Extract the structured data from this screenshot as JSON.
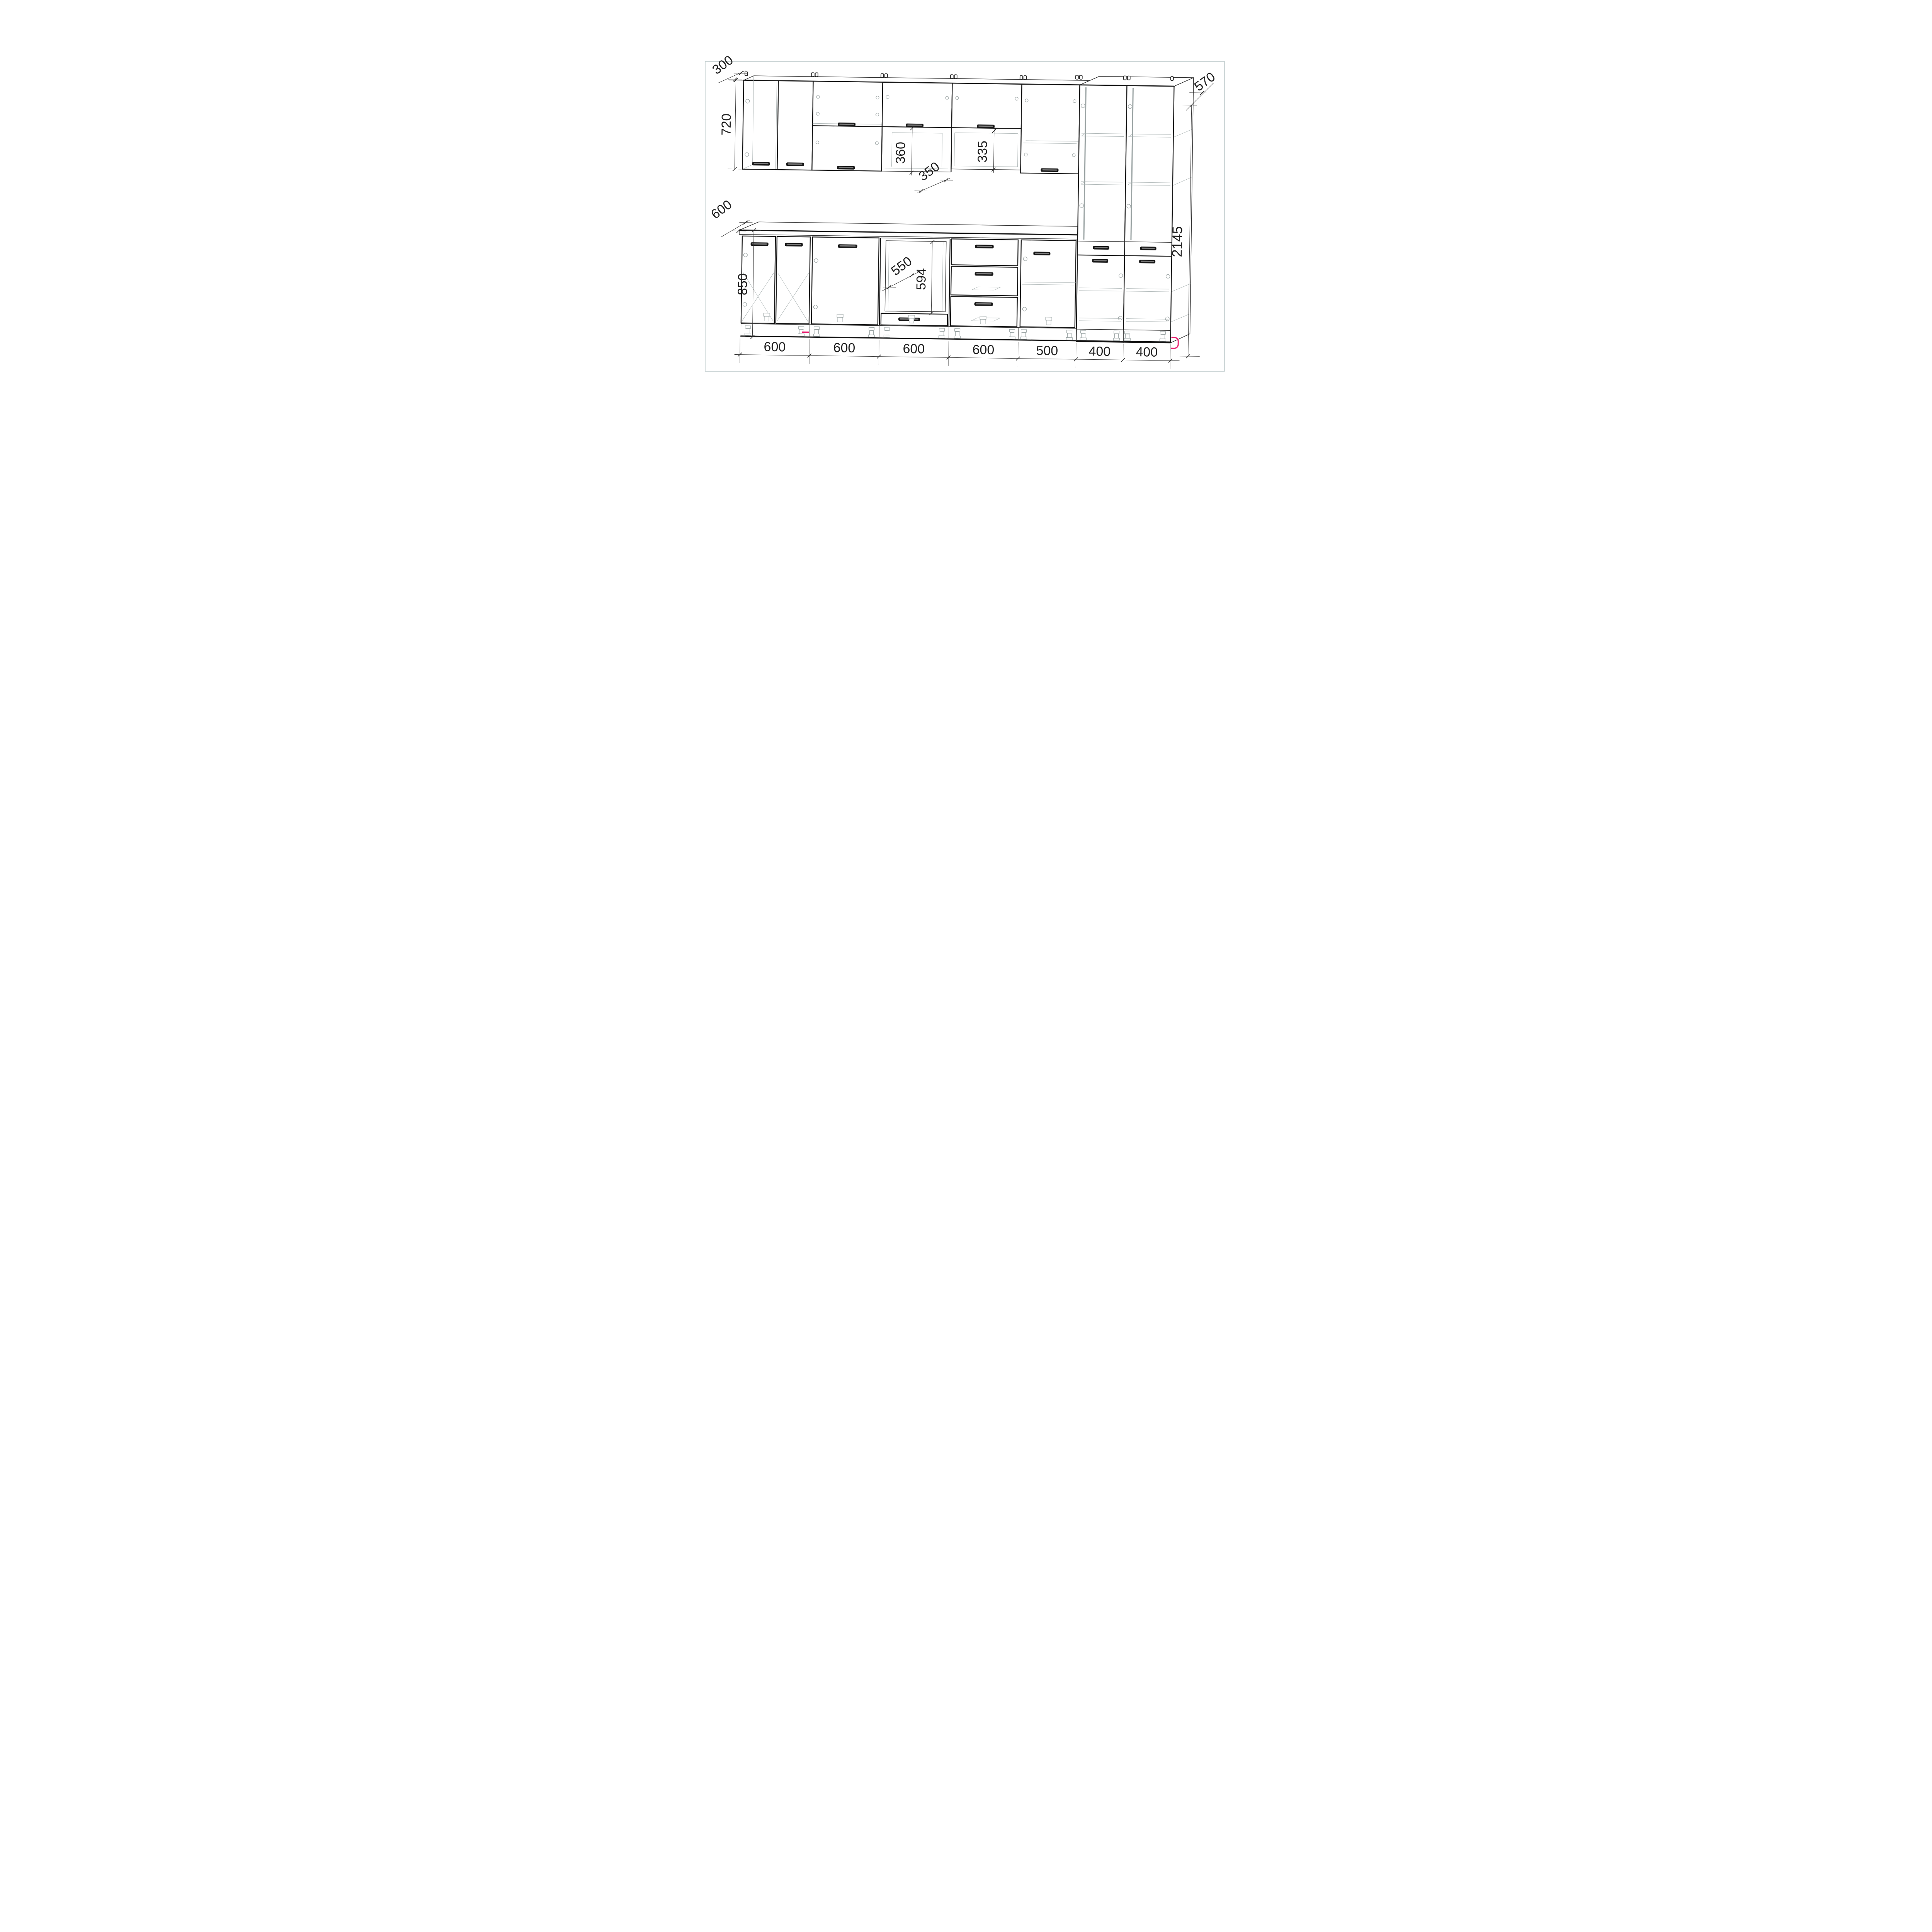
{
  "drawing": {
    "title": "kitchen-cabinet-set-dimension-drawing",
    "style": "wireframe-3d-elevation",
    "colors": {
      "outline": "#1a1a1a",
      "secondary_line": "#9aa4a4",
      "frame_border": "#b9c6c7",
      "accent": "#e9186c",
      "text": "#1f1f1f",
      "background": "#ffffff"
    },
    "upper_row": {
      "wall_depth_label": "300",
      "wall_height_label": "720",
      "open_gap_height_label": "360",
      "open_shelf_depth_label": "350",
      "open_niche_height_label": "335"
    },
    "tall_column": {
      "depth_label": "570",
      "height_label": "2145"
    },
    "base_row": {
      "counter_depth_label": "600",
      "base_height_label": "850",
      "oven_niche_width_label": "550",
      "oven_niche_height_label": "594"
    },
    "widths": [
      "600",
      "600",
      "600",
      "600",
      "500",
      "400",
      "400"
    ]
  }
}
